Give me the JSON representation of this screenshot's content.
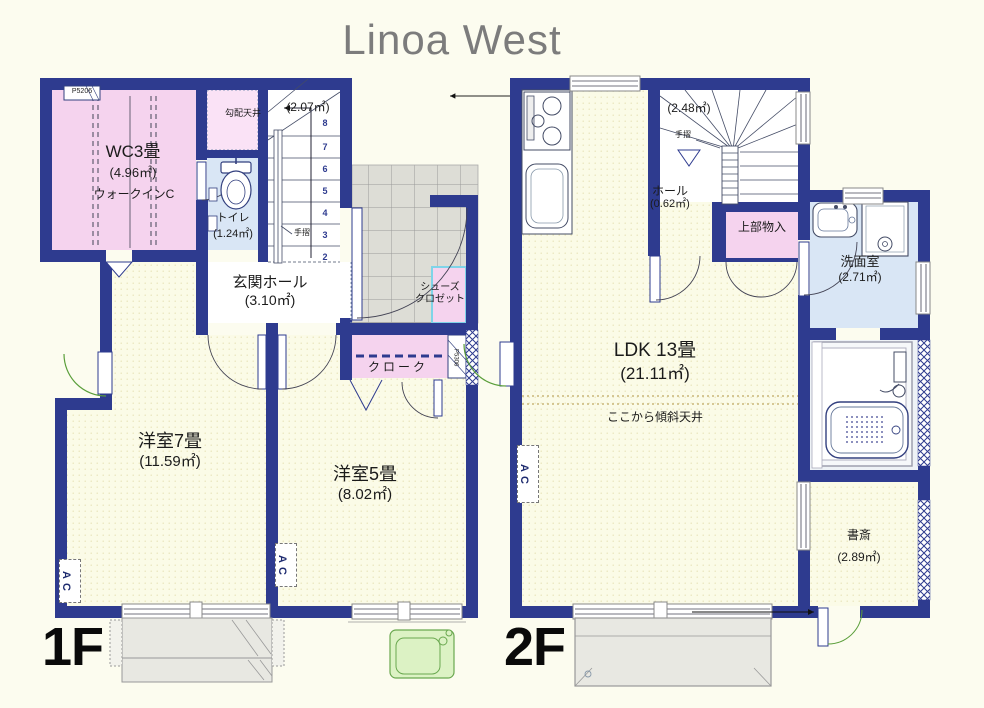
{
  "title": "Linoa West",
  "floor1": {
    "label": "1F",
    "post_top": "P5206",
    "post_right": "P5306",
    "wic": {
      "name": "WC3畳",
      "area": "(4.96㎡)",
      "sub": "ウォークインC"
    },
    "sloped_ceiling": "勾配天井",
    "toilet": {
      "name": "トイレ",
      "area": "(1.24㎡)"
    },
    "stairs": {
      "area": "(2.07㎡)",
      "handrail": "手摺",
      "steps": [
        "8",
        "7",
        "6",
        "5",
        "4",
        "3",
        "2"
      ]
    },
    "entrance_hall": {
      "name": "玄関ホール",
      "area": "(3.10㎡)"
    },
    "shoes_closet": {
      "line1": "シューズ",
      "line2": "クロゼット"
    },
    "cloak": "クローク",
    "room7": {
      "name": "洋室7畳",
      "area": "(11.59㎡)"
    },
    "room5": {
      "name": "洋室5畳",
      "area": "(8.02㎡)"
    },
    "ac": "AC"
  },
  "floor2": {
    "label": "2F",
    "stairs": {
      "area": "(2.48㎡)",
      "handrail": "手摺"
    },
    "hall": {
      "name": "ホール",
      "area": "(0.62㎡)"
    },
    "upper_storage": "上部物入",
    "washroom": {
      "name": "洗面室",
      "area": "(2.71㎡)"
    },
    "ldk": {
      "name": "LDK 13畳",
      "area": "(21.11㎡)",
      "ceiling_note": "ここから傾斜天井"
    },
    "study": {
      "name": "書斎",
      "area": "(2.89㎡)"
    },
    "ac": "AC"
  },
  "colors": {
    "wall": "#2e3b8f",
    "room_fill": "#FBFBE7",
    "pink": "#F5D3EE",
    "pink_light": "#FAE2F6",
    "blue_room": "#D9E6F5",
    "tile": "#DDDDD6",
    "terrace": "#E8E8E2",
    "green": "#DCF2C4",
    "green_line": "#5a9e3a",
    "title_gray": "#7c7c7c"
  }
}
